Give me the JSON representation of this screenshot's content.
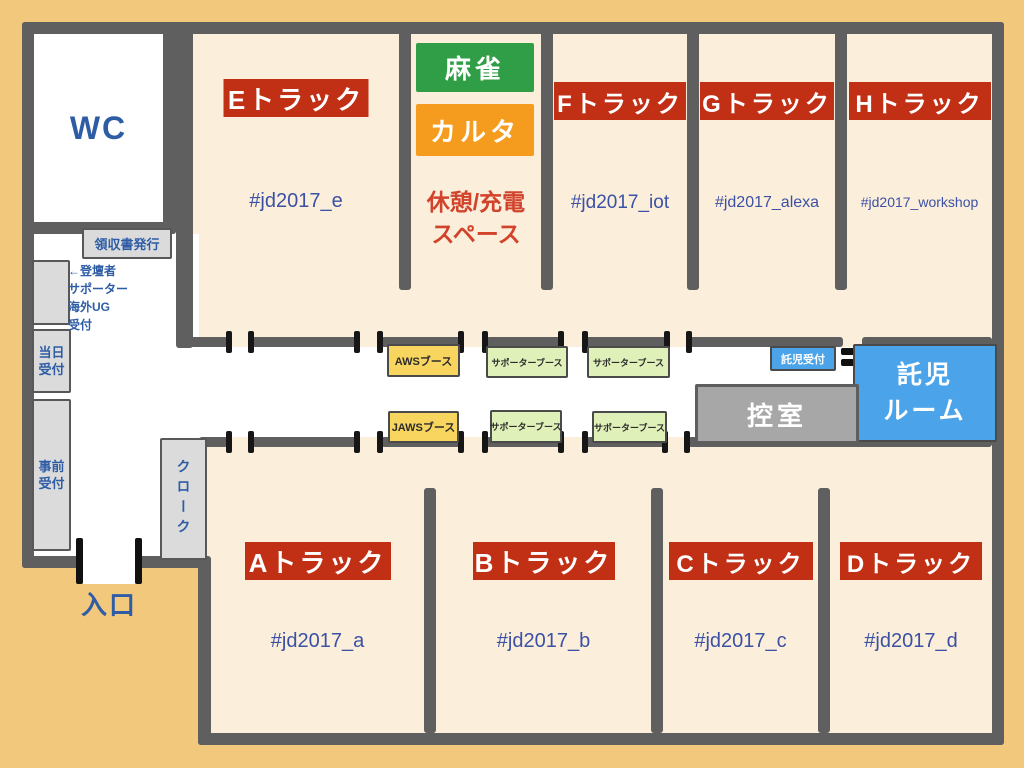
{
  "colors": {
    "background": "#F2C87D",
    "room_fill": "#FBEEDB",
    "wall": "#5F5F5F",
    "track_label_bg": "#C12F15",
    "track_label_text": "#FFFFFF",
    "hashtag_text": "#3B51A5",
    "jp_label_text": "#2E5DA6",
    "mahjong_bg": "#2F9E46",
    "karuta_bg": "#F59C1E",
    "rest_text": "#D2432C",
    "aws_booth_bg": "#F8D55E",
    "supporter_booth_bg": "#DFF0B9",
    "childcare_bg": "#4BA3E9",
    "greenroom_bg": "#A7A7A7"
  },
  "tracks": {
    "top": [
      {
        "label": "Eトラック",
        "hashtag": "#jd2017_e"
      },
      {
        "label": "Fトラック",
        "hashtag": "#jd2017_iot"
      },
      {
        "label": "Gトラック",
        "hashtag": "#jd2017_alexa"
      },
      {
        "label": "Hトラック",
        "hashtag": "#jd2017_workshop"
      }
    ],
    "bottom": [
      {
        "label": "Aトラック",
        "hashtag": "#jd2017_a"
      },
      {
        "label": "Bトラック",
        "hashtag": "#jd2017_b"
      },
      {
        "label": "Cトラック",
        "hashtag": "#jd2017_c"
      },
      {
        "label": "Dトラック",
        "hashtag": "#jd2017_d"
      }
    ]
  },
  "facilities": {
    "wc": "WC",
    "entrance": "入口",
    "cloakroom": "クローク",
    "receipt_desk": "領収書発行",
    "greenroom": "控室",
    "childcare_reception": "託児受付",
    "childcare_room": "託児\nルーム"
  },
  "reception": {
    "speaker_note": "←登壇者\nサポーター\n海外UG\n受付",
    "same_day": "当日\n受付",
    "advance": "事前\n受付"
  },
  "lounge": {
    "mahjong": "麻雀",
    "karuta": "カルタ",
    "rest_area": "休憩/充電\nスペース"
  },
  "booths": {
    "aws": "AWSブース",
    "jaws": "JAWSブース",
    "supporter": "サポーターブース"
  }
}
